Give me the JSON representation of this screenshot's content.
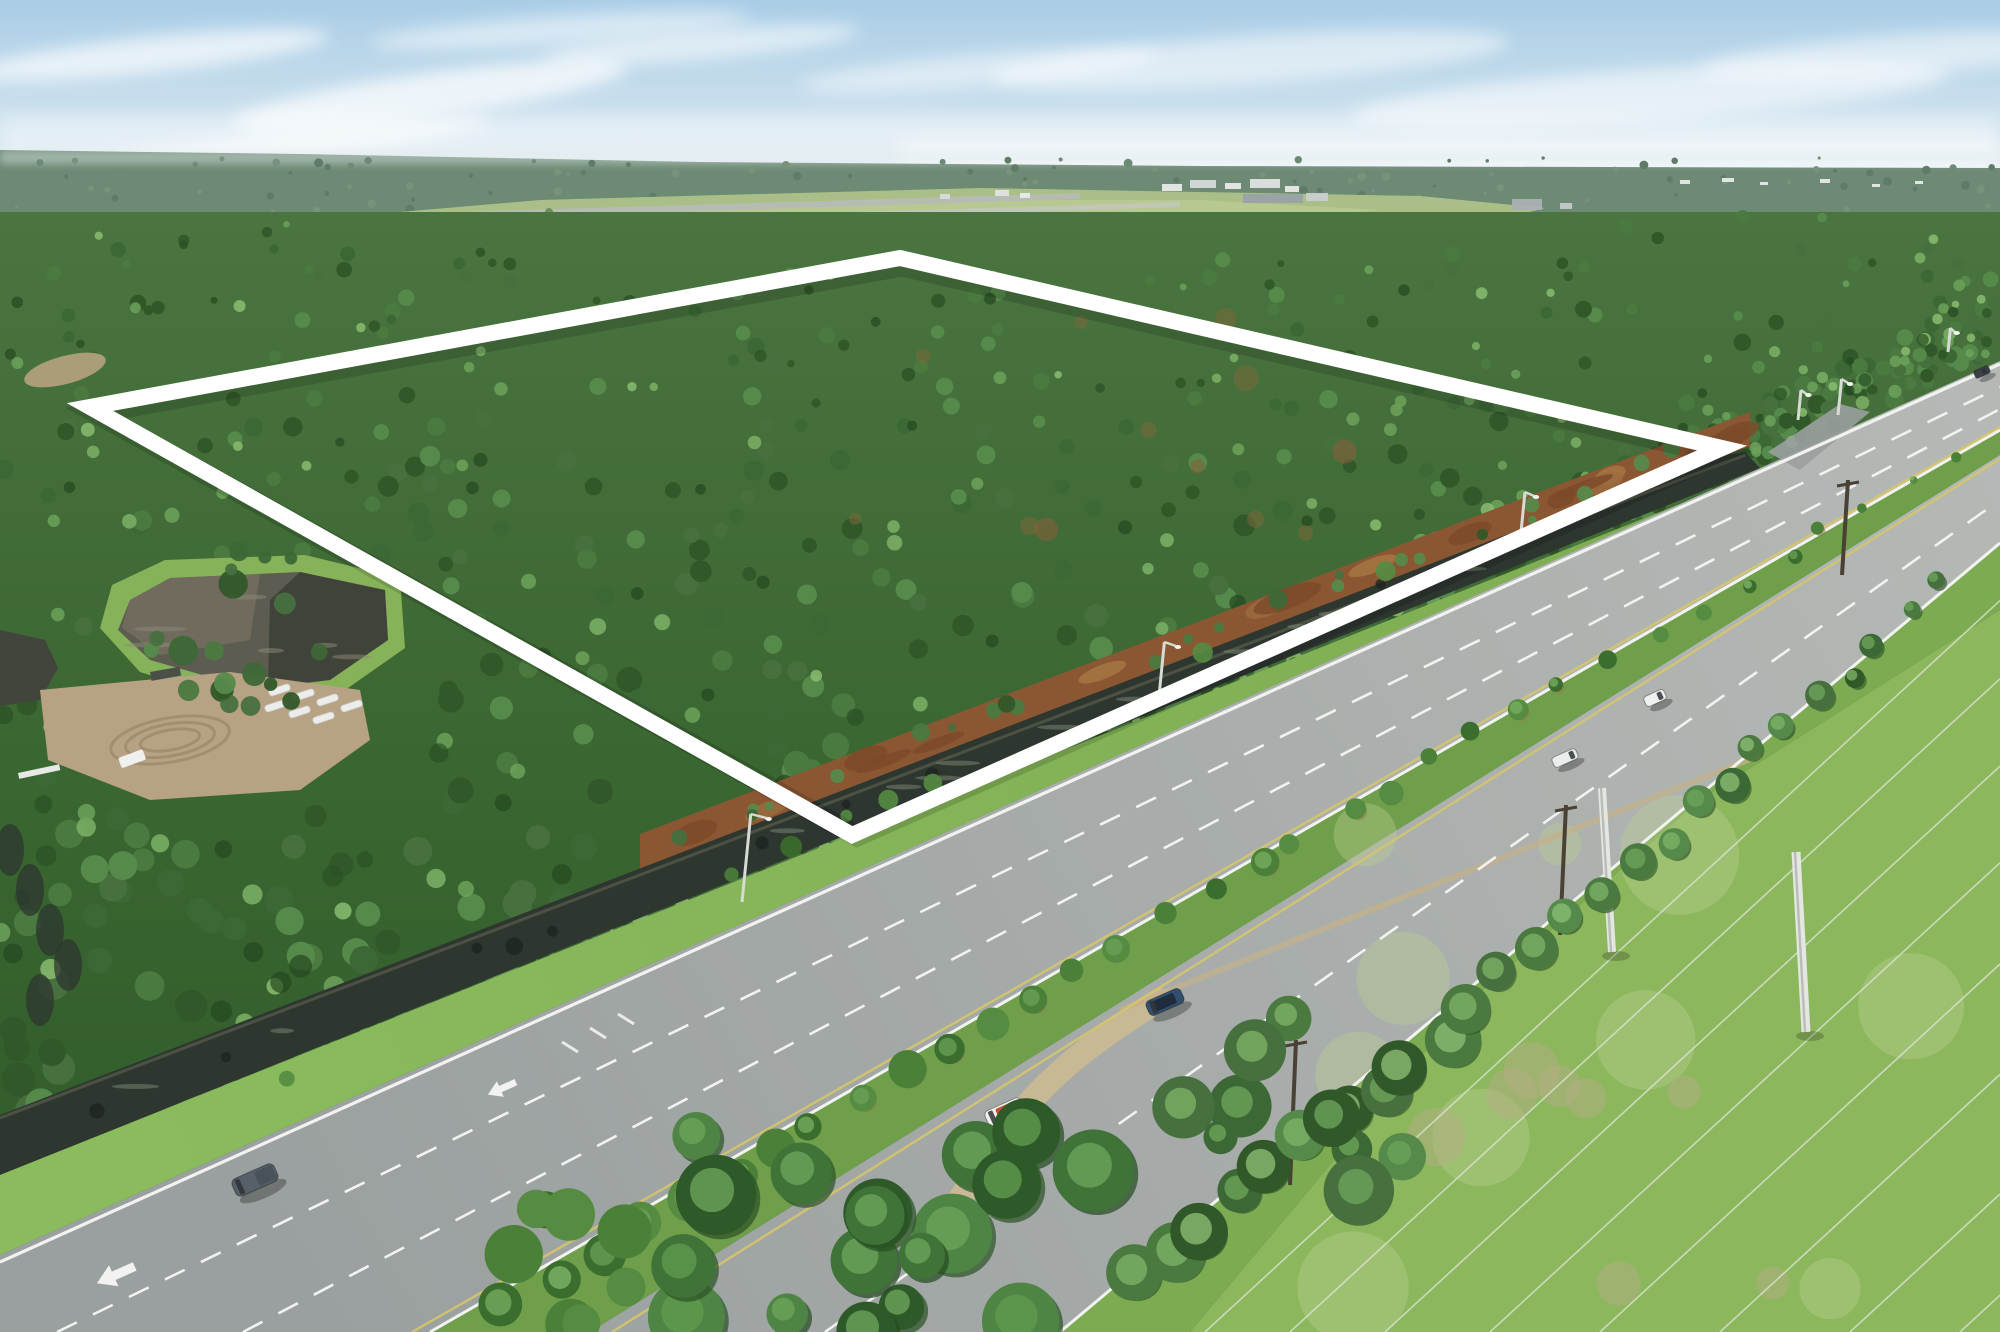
{
  "image": {
    "type": "aerial-drone-photograph",
    "subject": "Vacant wooded land parcel outlined in white beside a divided highway, with an airport runway on the horizon",
    "width_px": 2000,
    "height_px": 1332
  },
  "scene": {
    "sky": {
      "condition": "hazy blue with thin clouds"
    },
    "horizon": [
      "continuous pine forest",
      "airport runway and hangars",
      "distant white buildings"
    ],
    "parcel": {
      "land_cover": "dense pine forest",
      "boundary_shape": "four-corner polygon overlay",
      "boundary_color": "#ffffff",
      "cleared_dirt_strip": "red-brown cleared strip along canal edge"
    },
    "highway": {
      "type": "divided multi-lane highway",
      "median": "tree and shrub lined",
      "turn_arrows": 2,
      "markings": "white dashed lanes, solid white edge lines, yellow inner edge lines"
    },
    "canal": {
      "position": "drainage canal between parcel and highway"
    },
    "pond": {
      "position": "retention pond at left with dirt staging area and white culvert pipes"
    },
    "power_corridor": {
      "position": "open grass field bottom-right",
      "white_poles": 2,
      "wires": 8
    },
    "vehicles": [
      {
        "name": "pickup-truck",
        "body": "#566069",
        "detail": "#49525a"
      },
      {
        "name": "cargo-van-orange-roof",
        "body": "#eef0ee",
        "detail": "#c2512d"
      },
      {
        "name": "dark-blue-suv",
        "body": "#32506e",
        "detail": "#1e2c3c"
      },
      {
        "name": "white-car",
        "body": "#e9edec",
        "detail": "#9aa4a8"
      },
      {
        "name": "white-van",
        "body": "#eef0ed",
        "detail": "#39424a"
      },
      {
        "name": "distant-car",
        "body": "#3a4148",
        "detail": "#2a3036"
      }
    ]
  },
  "colors": {
    "sky_top": "#a9cde6",
    "sky_mid": "#cfe2ee",
    "sky_horizon": "#ecf2f5",
    "cloud": "#ffffff",
    "haze_band": "#dfe8ea",
    "horizon_forest": "#6d8a74",
    "horizon_forest_dark": "#5f7d66",
    "horizon_forest_light": "#78937b",
    "airfield": "#aabf87",
    "airfield_light": "#bccd96",
    "runway": "#b7bcb3",
    "taxiway": "#c2c7bd",
    "building_white": "#e8eae8",
    "building_gray": "#9aa2a6",
    "forest_top": "#4a7440",
    "forest_mid": "#3a6631",
    "forest_bottom": "#2f5a2a",
    "canopy": [
      "#3c6836",
      "#4a7a40",
      "#568a4b",
      "#47703f",
      "#315829"
    ],
    "canopy_light": [
      "#6ca25a",
      "#7cb065",
      "#8abc70"
    ],
    "canopy_dark": [
      "#2a5124",
      "#24481f"
    ],
    "autumn": "#7a6a3a",
    "dirt": "#8a5732",
    "dirt_light": "#9c6b3e",
    "dirt_dark": "#7a4a28",
    "canal": "#2e3630",
    "canal_dark": "#1e241f",
    "canal_glint": "#7e8874",
    "canal_bank": "#55594a",
    "grass_bright": "#8abb5d",
    "grass_far": "#7cab50",
    "verge": "#7cab51",
    "field": "#8cb75c",
    "field_pale": "#b9cd92",
    "field_sand": "#b9ac88",
    "road": "#9aa09f",
    "road_far": "#b5b9b6",
    "median_green": "#6f9f4a",
    "bush": [
      "#4a8038",
      "#558c42",
      "#3b6e2e"
    ],
    "mulch": "#9a7a4e",
    "marking_white": "#f2f3f0",
    "marking_yellow": "#d6c66a",
    "outline": "#ffffff",
    "pond_water": "#5c5c50",
    "pond_light": "#7d7464",
    "pond_dark": "#35392f",
    "staging_dirt": "#b7a284",
    "track": "#9d8a6c",
    "pipe_white": "#ecedea",
    "path_sand": "#c9b994",
    "pole_light": "#d8dad4",
    "pole_dark": "#4a4136",
    "pole_white": "#e3e6e1",
    "wire": "#dfe7da",
    "shadow": "#000000"
  }
}
